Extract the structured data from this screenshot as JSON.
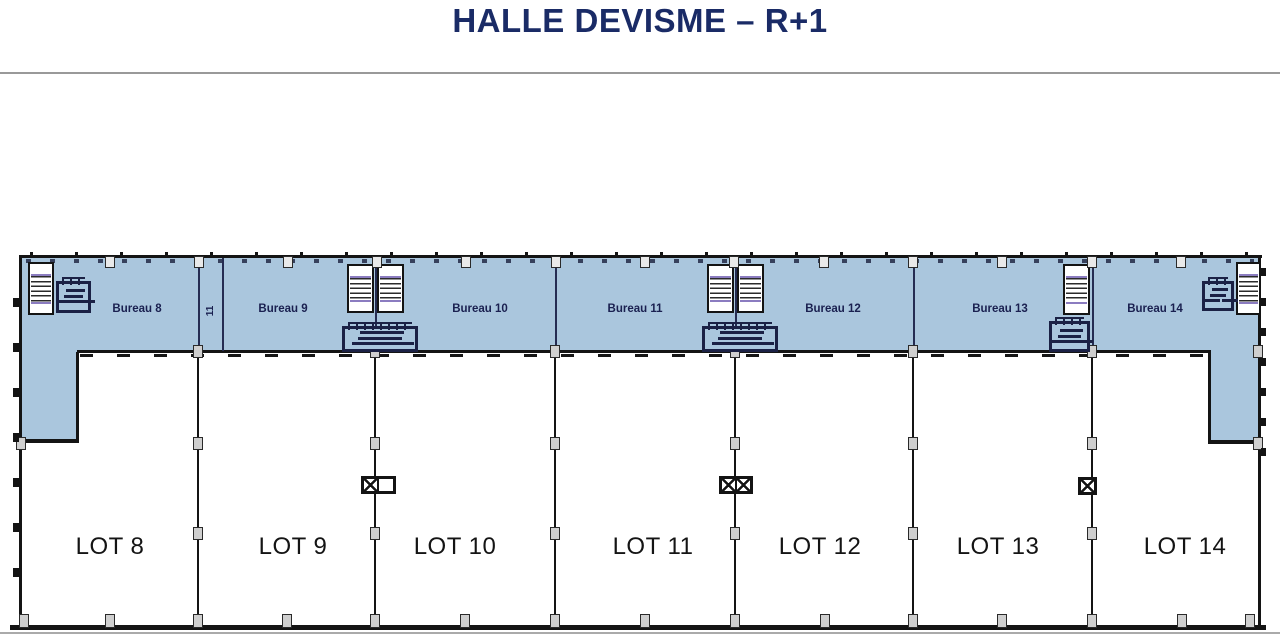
{
  "title": "HALLE DEVISME – R+1",
  "colors": {
    "title_navy": "#1a2b66",
    "plan_fill_blue": "#aac6dd",
    "wall_black": "#141414",
    "label_navy": "#1a2050",
    "column_gray": "#cfcfcf",
    "stair_accent": "#8b7cc0"
  },
  "plan": {
    "corridor_label": "11",
    "bureaus": [
      {
        "label": "Bureau 8",
        "cx": 137
      },
      {
        "label": "Bureau 9",
        "cx": 283
      },
      {
        "label": "Bureau 10",
        "cx": 480
      },
      {
        "label": "Bureau 11",
        "cx": 635
      },
      {
        "label": "Bureau 12",
        "cx": 833
      },
      {
        "label": "Bureau 13",
        "cx": 1000
      },
      {
        "label": "Bureau 14",
        "cx": 1155
      }
    ],
    "lots": [
      {
        "label": "LOT 8",
        "cx": 110
      },
      {
        "label": "LOT 9",
        "cx": 293
      },
      {
        "label": "LOT 10",
        "cx": 455
      },
      {
        "label": "LOT 11",
        "cx": 653
      },
      {
        "label": "LOT 12",
        "cx": 820
      },
      {
        "label": "LOT 13",
        "cx": 998
      },
      {
        "label": "LOT 14",
        "cx": 1185
      }
    ],
    "dividers_x": [
      198,
      375,
      555,
      735,
      913,
      1092
    ],
    "band_lines_x": [
      198,
      222,
      375,
      555,
      735,
      913,
      1092
    ],
    "top_tabs_x": [
      110,
      199,
      288,
      377,
      466,
      556,
      645,
      734,
      824,
      913,
      1002,
      1092,
      1181
    ],
    "bottom_columns_x": [
      24,
      110,
      198,
      287,
      375,
      465,
      555,
      645,
      735,
      825,
      913,
      1002,
      1092,
      1182,
      1250
    ],
    "wall_columns": [
      [
        16,
        437
      ],
      [
        1253,
        345
      ],
      [
        1253,
        437
      ]
    ],
    "stairs": [
      {
        "x": 28,
        "y": 262,
        "w": 26,
        "h": 53
      },
      {
        "x": 347,
        "y": 264,
        "w": 27,
        "h": 49
      },
      {
        "x": 377,
        "y": 264,
        "w": 27,
        "h": 49
      },
      {
        "x": 707,
        "y": 264,
        "w": 27,
        "h": 49
      },
      {
        "x": 737,
        "y": 264,
        "w": 27,
        "h": 49
      },
      {
        "x": 1063,
        "y": 264,
        "w": 27,
        "h": 51
      },
      {
        "x": 1236,
        "y": 262,
        "w": 25,
        "h": 53
      }
    ],
    "toilets": [
      {
        "x": 56,
        "y": 281,
        "w": 35,
        "h": 32
      },
      {
        "x": 342,
        "y": 326,
        "w": 76,
        "h": 26
      },
      {
        "x": 702,
        "y": 326,
        "w": 76,
        "h": 26
      },
      {
        "x": 1049,
        "y": 321,
        "w": 41,
        "h": 31
      },
      {
        "x": 1202,
        "y": 281,
        "w": 32,
        "h": 30
      }
    ],
    "xboxes": [
      {
        "x": 361,
        "y": 476,
        "cells": 1,
        "tail": true
      },
      {
        "x": 719,
        "y": 476,
        "cells": 2,
        "tail": false
      },
      {
        "x": 1078,
        "y": 477,
        "cells": 1,
        "tail": false
      }
    ],
    "left_ticks_y": [
      298,
      343,
      388,
      433,
      478,
      523,
      568
    ],
    "right_ticks_y": [
      268,
      298,
      328,
      358,
      388,
      418,
      448
    ]
  }
}
